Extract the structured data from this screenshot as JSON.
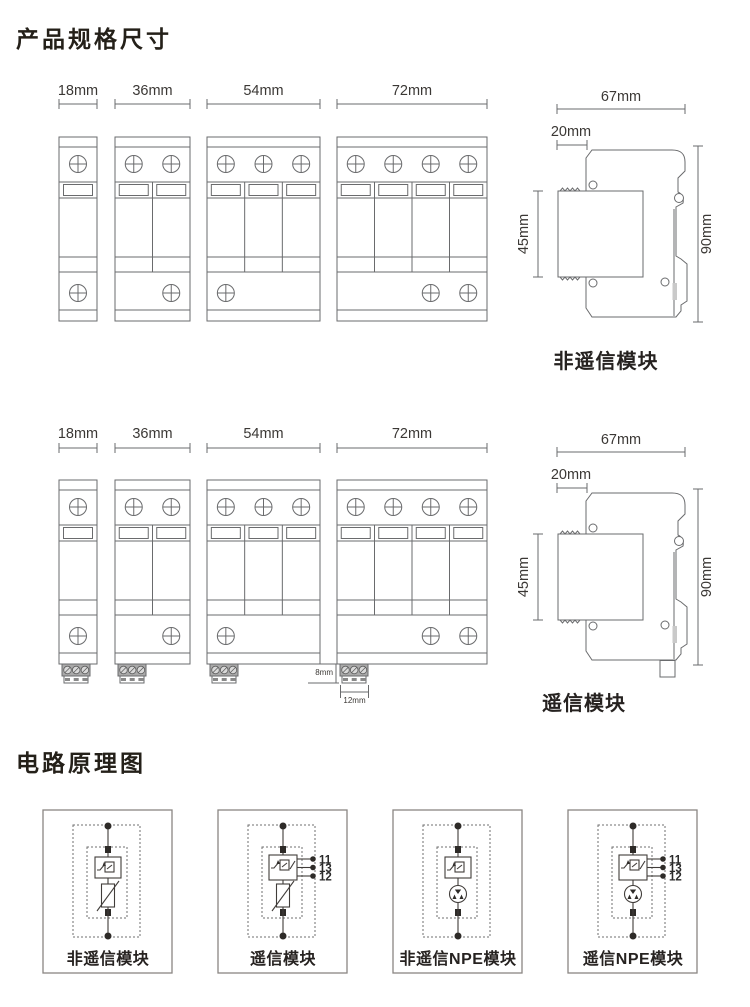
{
  "page": {
    "title_spec": "产品规格尺寸",
    "title_circuit": "电路原理图",
    "background": "#ffffff"
  },
  "colors": {
    "drawing_line": "#6a6b6d",
    "circuit_line": "#413d3a",
    "text": "#242019"
  },
  "spec": {
    "width_labels": [
      "18mm",
      "36mm",
      "54mm",
      "72mm"
    ],
    "modules": [
      {
        "label": "18mm",
        "poles": 1,
        "bottom_screws": [
          0
        ]
      },
      {
        "label": "36mm",
        "poles": 2,
        "bottom_screws": [
          1
        ]
      },
      {
        "label": "54mm",
        "poles": 3,
        "bottom_screws": [
          0
        ]
      },
      {
        "label": "72mm",
        "poles": 4,
        "bottom_screws": [
          2,
          3
        ]
      }
    ],
    "side_view": {
      "top": "67mm",
      "offset": "20mm",
      "module_height": "45mm",
      "total_height": "90mm"
    },
    "rows": [
      {
        "caption": "非遥信模块",
        "has_signal_terminal": false
      },
      {
        "caption": "遥信模块",
        "has_signal_terminal": true,
        "terminal_height": "8mm",
        "terminal_width": "12mm"
      }
    ]
  },
  "circuit": {
    "cards": [
      {
        "label": "非遥信模块",
        "protection": "varistor",
        "remote": false
      },
      {
        "label": "遥信模块",
        "protection": "varistor",
        "remote": true,
        "terminals": [
          "11",
          "13",
          "12"
        ]
      },
      {
        "label": "非遥信NPE模块",
        "protection": "gdt",
        "remote": false
      },
      {
        "label": "遥信NPE模块",
        "protection": "gdt",
        "remote": true,
        "terminals": [
          "11",
          "13",
          "12"
        ]
      }
    ]
  }
}
